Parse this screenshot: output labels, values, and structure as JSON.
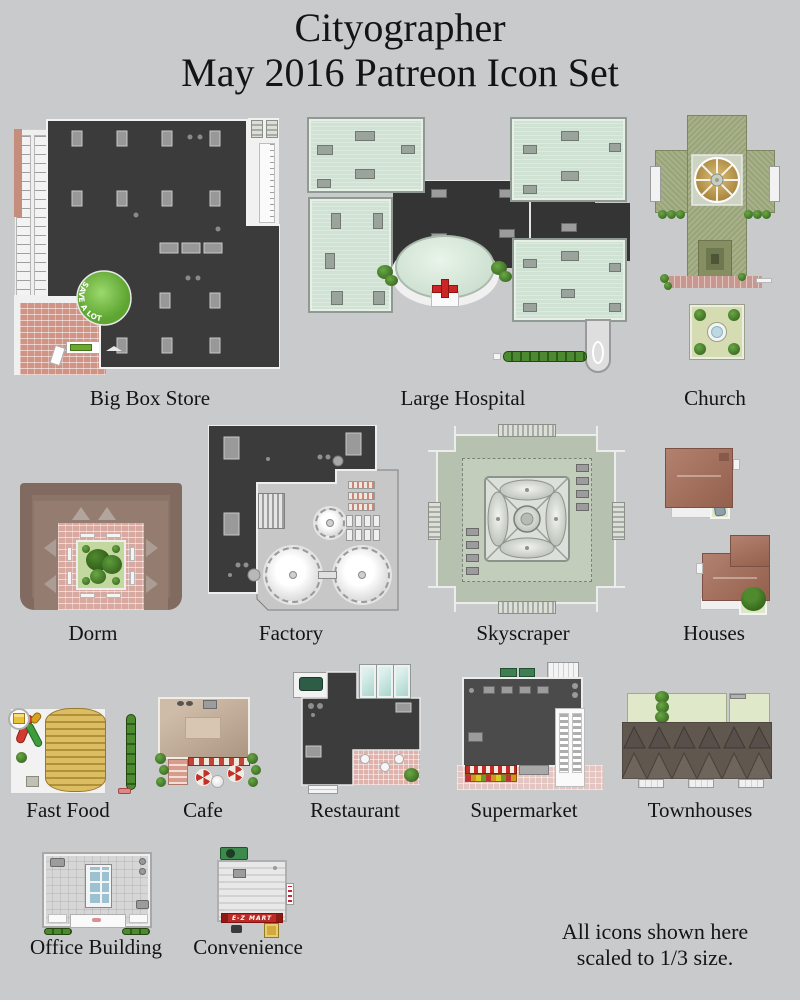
{
  "page": {
    "title_line1": "Cityographer",
    "title_line2": "May 2016 Patreon Icon Set",
    "footer_line1": "All icons shown here",
    "footer_line2": "scaled to 1/3 size."
  },
  "colors": {
    "background": "#c9cacc",
    "dark_roof": "#3b3b3b",
    "hospital_mint": "#cfe2d3",
    "church_olive": "#99a478",
    "skyscraper_sage": "#b7c1af",
    "dorm_mauve": "#8b7468",
    "house_terracotta": "#a8735f",
    "fastfood_gold": "#d7b658",
    "sign_green": "#74bd4a",
    "sign_red": "#bb2a24",
    "cross_red": "#cc2525"
  },
  "icons": [
    {
      "id": "big-box-store",
      "label": "Big Box Store",
      "sign_text": "SAVE A LOT"
    },
    {
      "id": "large-hospital",
      "label": "Large Hospital"
    },
    {
      "id": "church",
      "label": "Church"
    },
    {
      "id": "dorm",
      "label": "Dorm"
    },
    {
      "id": "factory",
      "label": "Factory"
    },
    {
      "id": "skyscraper",
      "label": "Skyscraper"
    },
    {
      "id": "houses",
      "label": "Houses"
    },
    {
      "id": "fast-food",
      "label": "Fast Food"
    },
    {
      "id": "cafe",
      "label": "Cafe"
    },
    {
      "id": "restaurant",
      "label": "Restaurant"
    },
    {
      "id": "supermarket",
      "label": "Supermarket"
    },
    {
      "id": "townhouses",
      "label": "Townhouses"
    },
    {
      "id": "office-building",
      "label": "Office Building"
    },
    {
      "id": "convenience",
      "label": "Convenience",
      "sign_text": "E-Z MART"
    }
  ]
}
